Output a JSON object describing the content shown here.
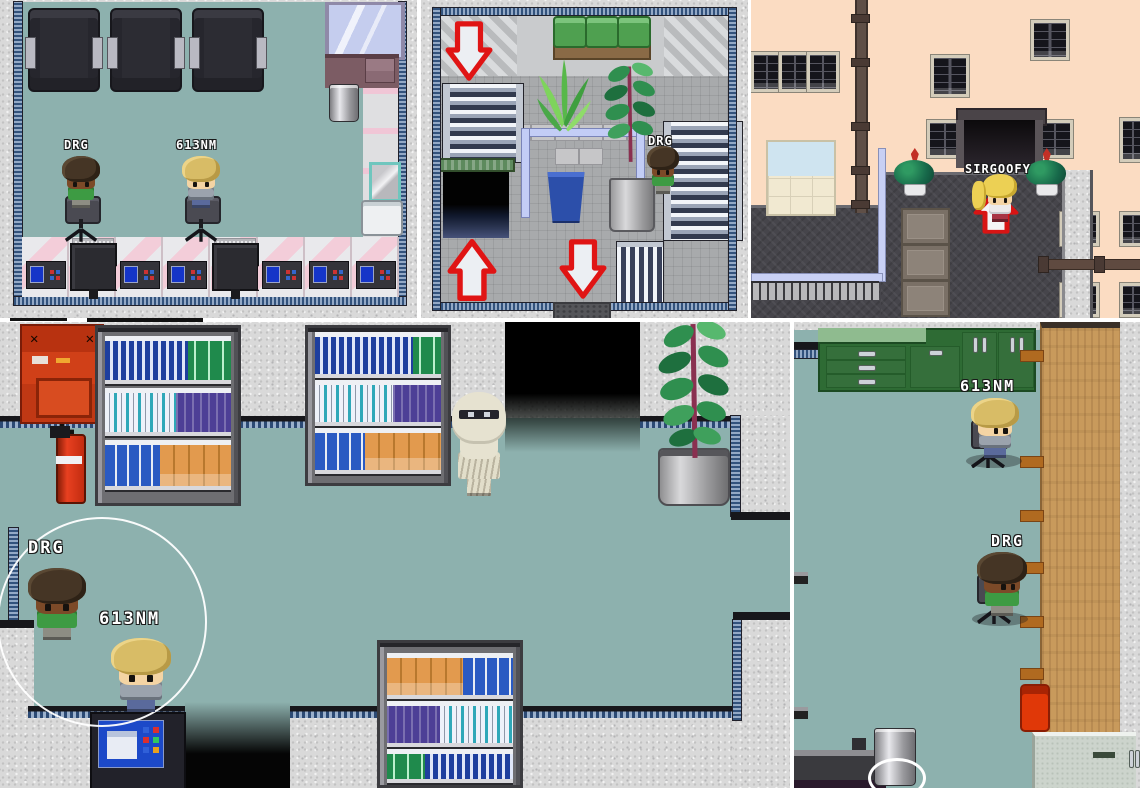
{
  "panels": {
    "computer_room": {
      "players": [
        {
          "name": "DRG"
        },
        {
          "name": "613NM"
        }
      ]
    },
    "stair_hall": {
      "players": [
        {
          "name": "DRG"
        }
      ]
    },
    "street": {
      "players": [
        {
          "name": "SIRGOOFY"
        }
      ]
    },
    "store": {
      "players": [
        {
          "name": "DRG"
        },
        {
          "name": "613NM"
        }
      ]
    },
    "office": {
      "players": [
        {
          "name": "613NM"
        },
        {
          "name": "DRG"
        }
      ]
    }
  },
  "palette": {
    "floor_teal": "#8db1ae",
    "tile_gray": "#a8aaac",
    "granite": "#d9d9d9",
    "trim_blue": "#32527c",
    "wall_dark": "#17171b",
    "peach_wall": "#fbdcc2",
    "courtyard_dark": "#46454b",
    "cabinet_green": "#2e6b34",
    "bench_green": "#4fa050",
    "wood_tan": "#c89a5c",
    "arrow_red": "#e01414",
    "safety_box_red": "#d04018",
    "extinguisher_red": "#cc2e10",
    "label_text": "#ffffff"
  }
}
